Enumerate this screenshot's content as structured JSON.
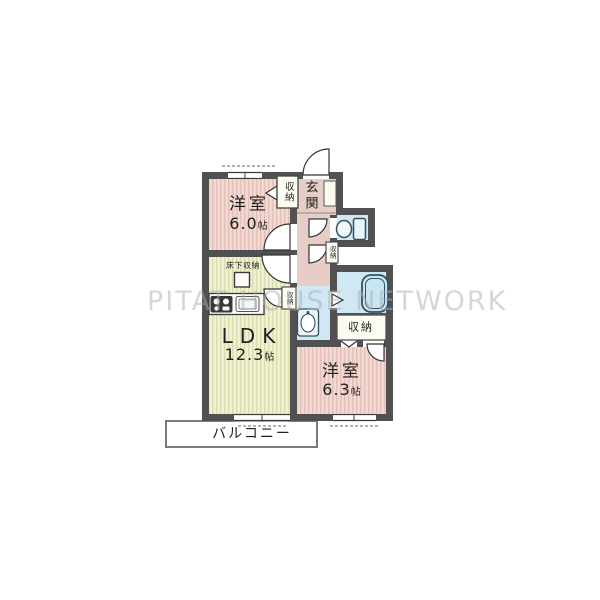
{
  "watermark": "PITAT HOUSE NETWORK",
  "rooms": {
    "bedroom1": {
      "label": "洋室",
      "size_num": "6.0",
      "size_unit": "帖"
    },
    "ldk": {
      "label": "LDK",
      "size_num": "12.3",
      "size_unit": "帖"
    },
    "bedroom2": {
      "label": "洋室",
      "size_num": "6.3",
      "size_unit": "帖"
    },
    "entrance": {
      "label": "玄関"
    },
    "balcony": {
      "label": "バルコニー"
    },
    "underfloor_storage": {
      "label": "床下収納"
    },
    "closet_bedroom1": {
      "label": "収納"
    },
    "closet_hallway": {
      "label": "収納"
    },
    "closet_ldk": {
      "label": "収納"
    },
    "closet_bedroom2": {
      "label": "収納"
    }
  },
  "colors": {
    "wall": "#515151",
    "bedroom_fill": "#f1d9d1",
    "bedroom_stripe": "#e3c1b8",
    "ldk_fill": "#eff0d4",
    "ldk_stripe": "#dcddae",
    "hallway_fill": "#e6cdc6",
    "water_fill": "#cfe8f3",
    "fixture_outline": "#33525f",
    "watermark": "#aeb0b2"
  }
}
